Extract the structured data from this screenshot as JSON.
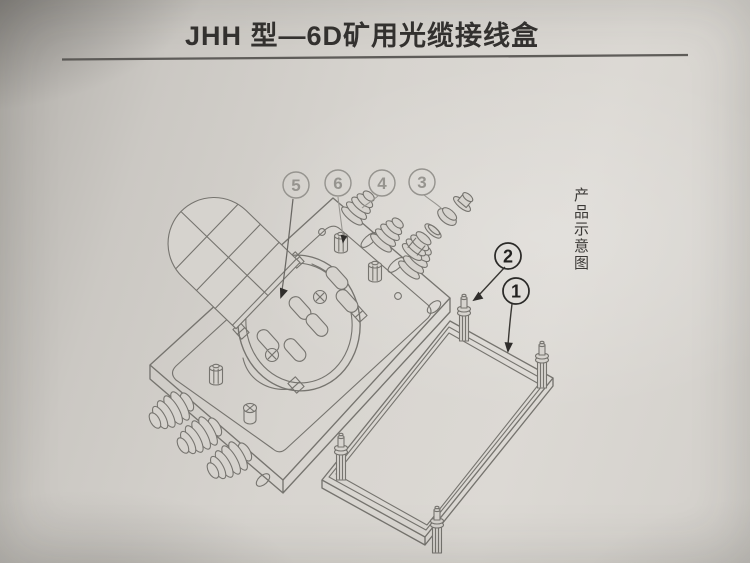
{
  "page": {
    "title": "JHH 型—6D矿用光缆接线盒",
    "side_label": "产品示意图"
  },
  "callouts": [
    {
      "label": "5",
      "style": "light"
    },
    {
      "label": "6",
      "style": "light"
    },
    {
      "label": "4",
      "style": "light"
    },
    {
      "label": "3",
      "style": "light"
    },
    {
      "label": "2",
      "style": "dark"
    },
    {
      "label": "1",
      "style": "dark"
    }
  ],
  "colors": {
    "paper": "#d6d3ce",
    "line": "#76746f",
    "line_light": "#979590",
    "ink": "#343230",
    "callout_light": "#96948f",
    "callout_dark": "#2b2a28"
  }
}
